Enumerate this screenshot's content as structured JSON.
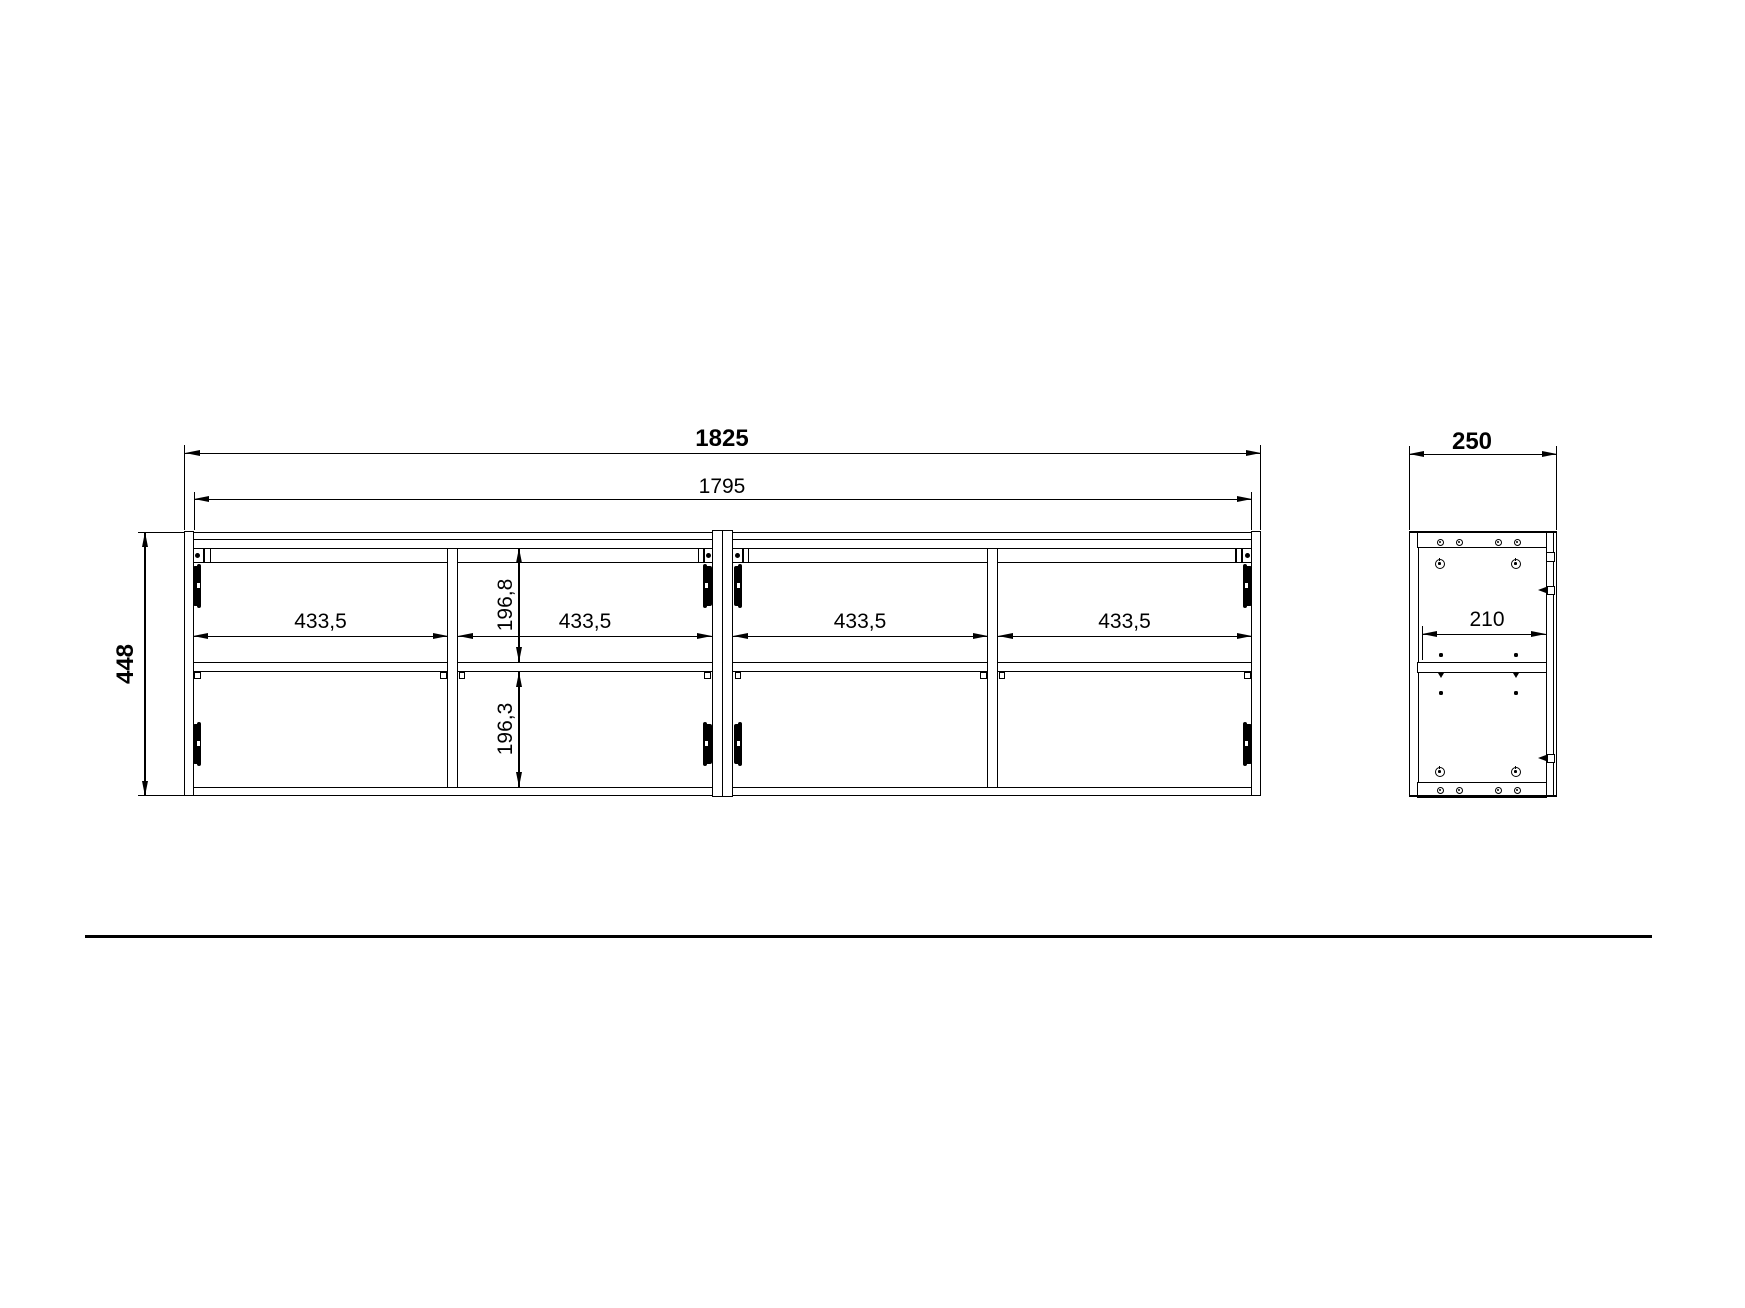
{
  "front_view": {
    "overall_width": "1825",
    "inner_width": "1795",
    "overall_height": "448",
    "compartment_widths": [
      "433,5",
      "433,5",
      "433,5",
      "433,5"
    ],
    "upper_compartment_height": "196,8",
    "lower_compartment_height": "196,3"
  },
  "side_view": {
    "overall_depth": "250",
    "inner_depth": "210"
  },
  "colors": {
    "line": "#000000",
    "background": "#ffffff"
  }
}
